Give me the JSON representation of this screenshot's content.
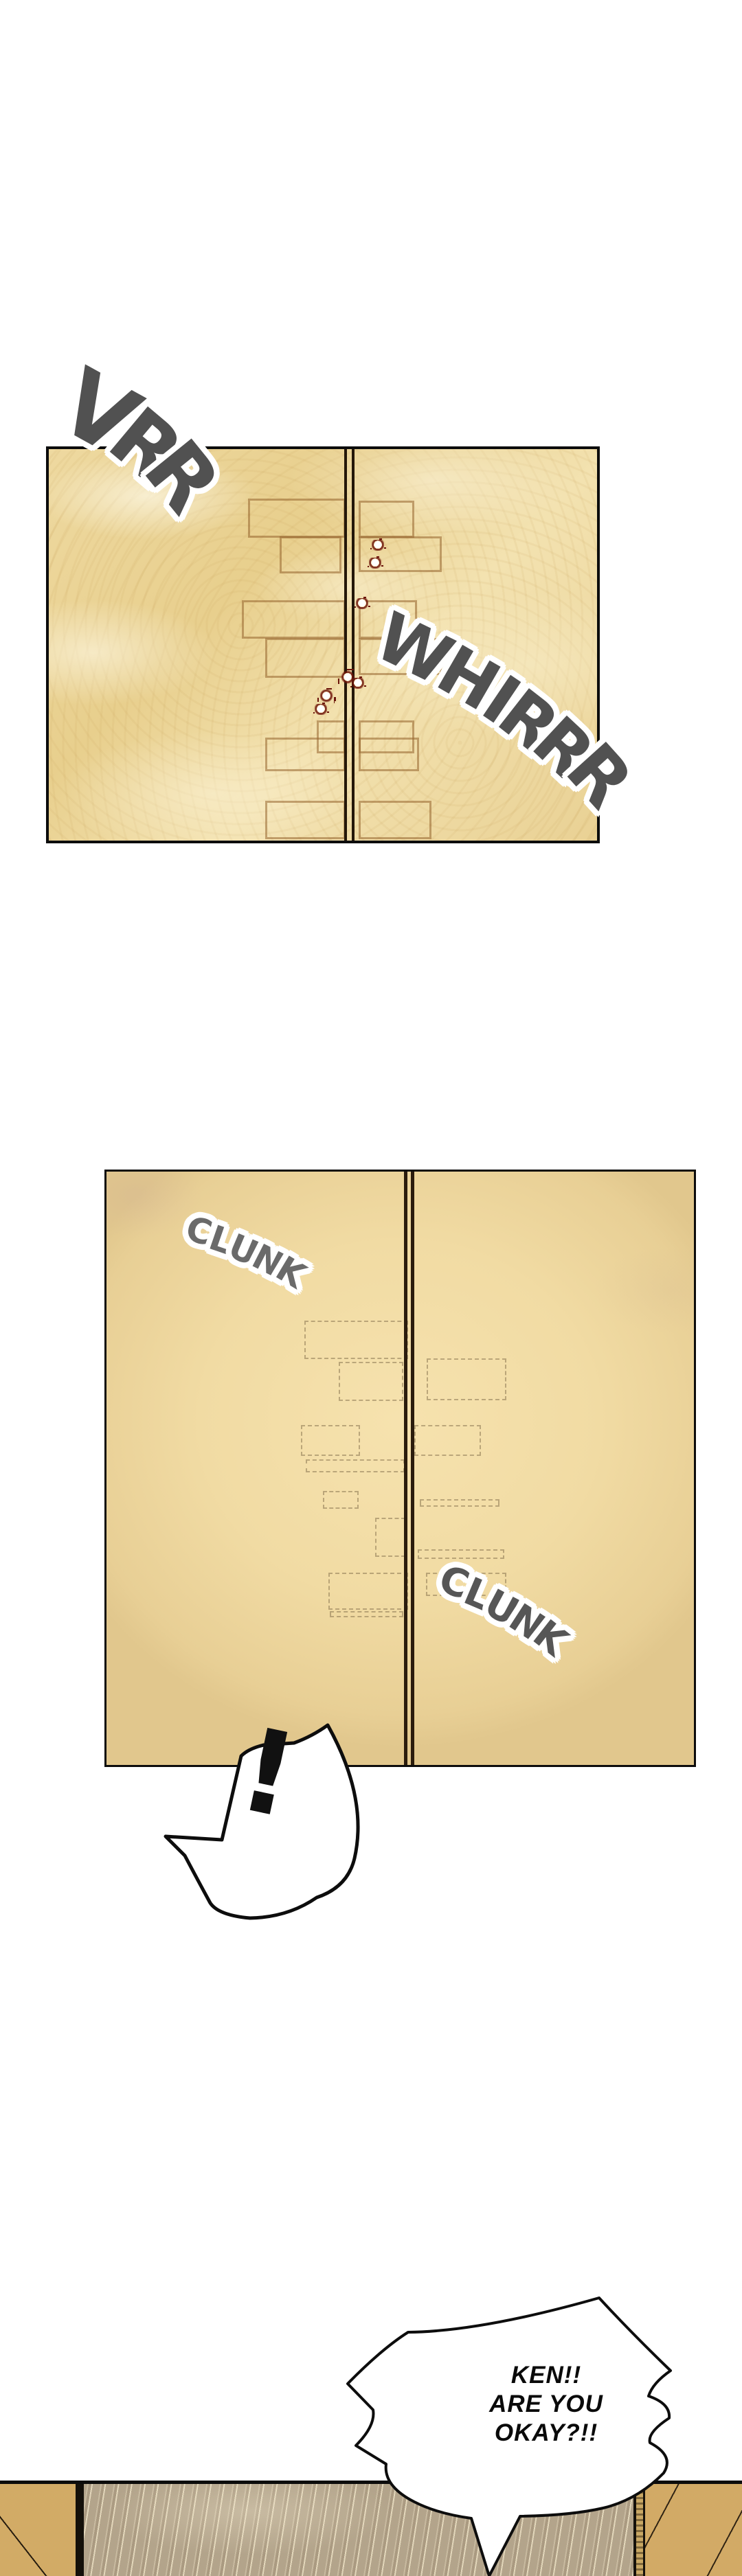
{
  "comic": {
    "panel1": {
      "sfx_left": "VRR",
      "sfx_right": "WHIRRR"
    },
    "panel2": {
      "sfx_top": "CLUNK",
      "sfx_bottom": "CLUNK",
      "burst": "!"
    },
    "panel3": {
      "speech": [
        "KEN!!",
        "ARE YOU",
        "OKAY?!!"
      ]
    }
  },
  "colors": {
    "page_bg": "#ffffff",
    "panel_border": "#0c0c0c",
    "panel1_bg": "#eed9a0",
    "panel2_bg": "#f2dda6",
    "door_seam": "#241709",
    "door_molding": "#a5763a",
    "bullet_splatter": "#6b150b",
    "sfx_gray": "#515151",
    "sfx_outline": "#ffffff",
    "floor_wood": "#b3a48b",
    "side_wall_tan": "#d2ab66",
    "speech_text": "#0a0a0a"
  }
}
